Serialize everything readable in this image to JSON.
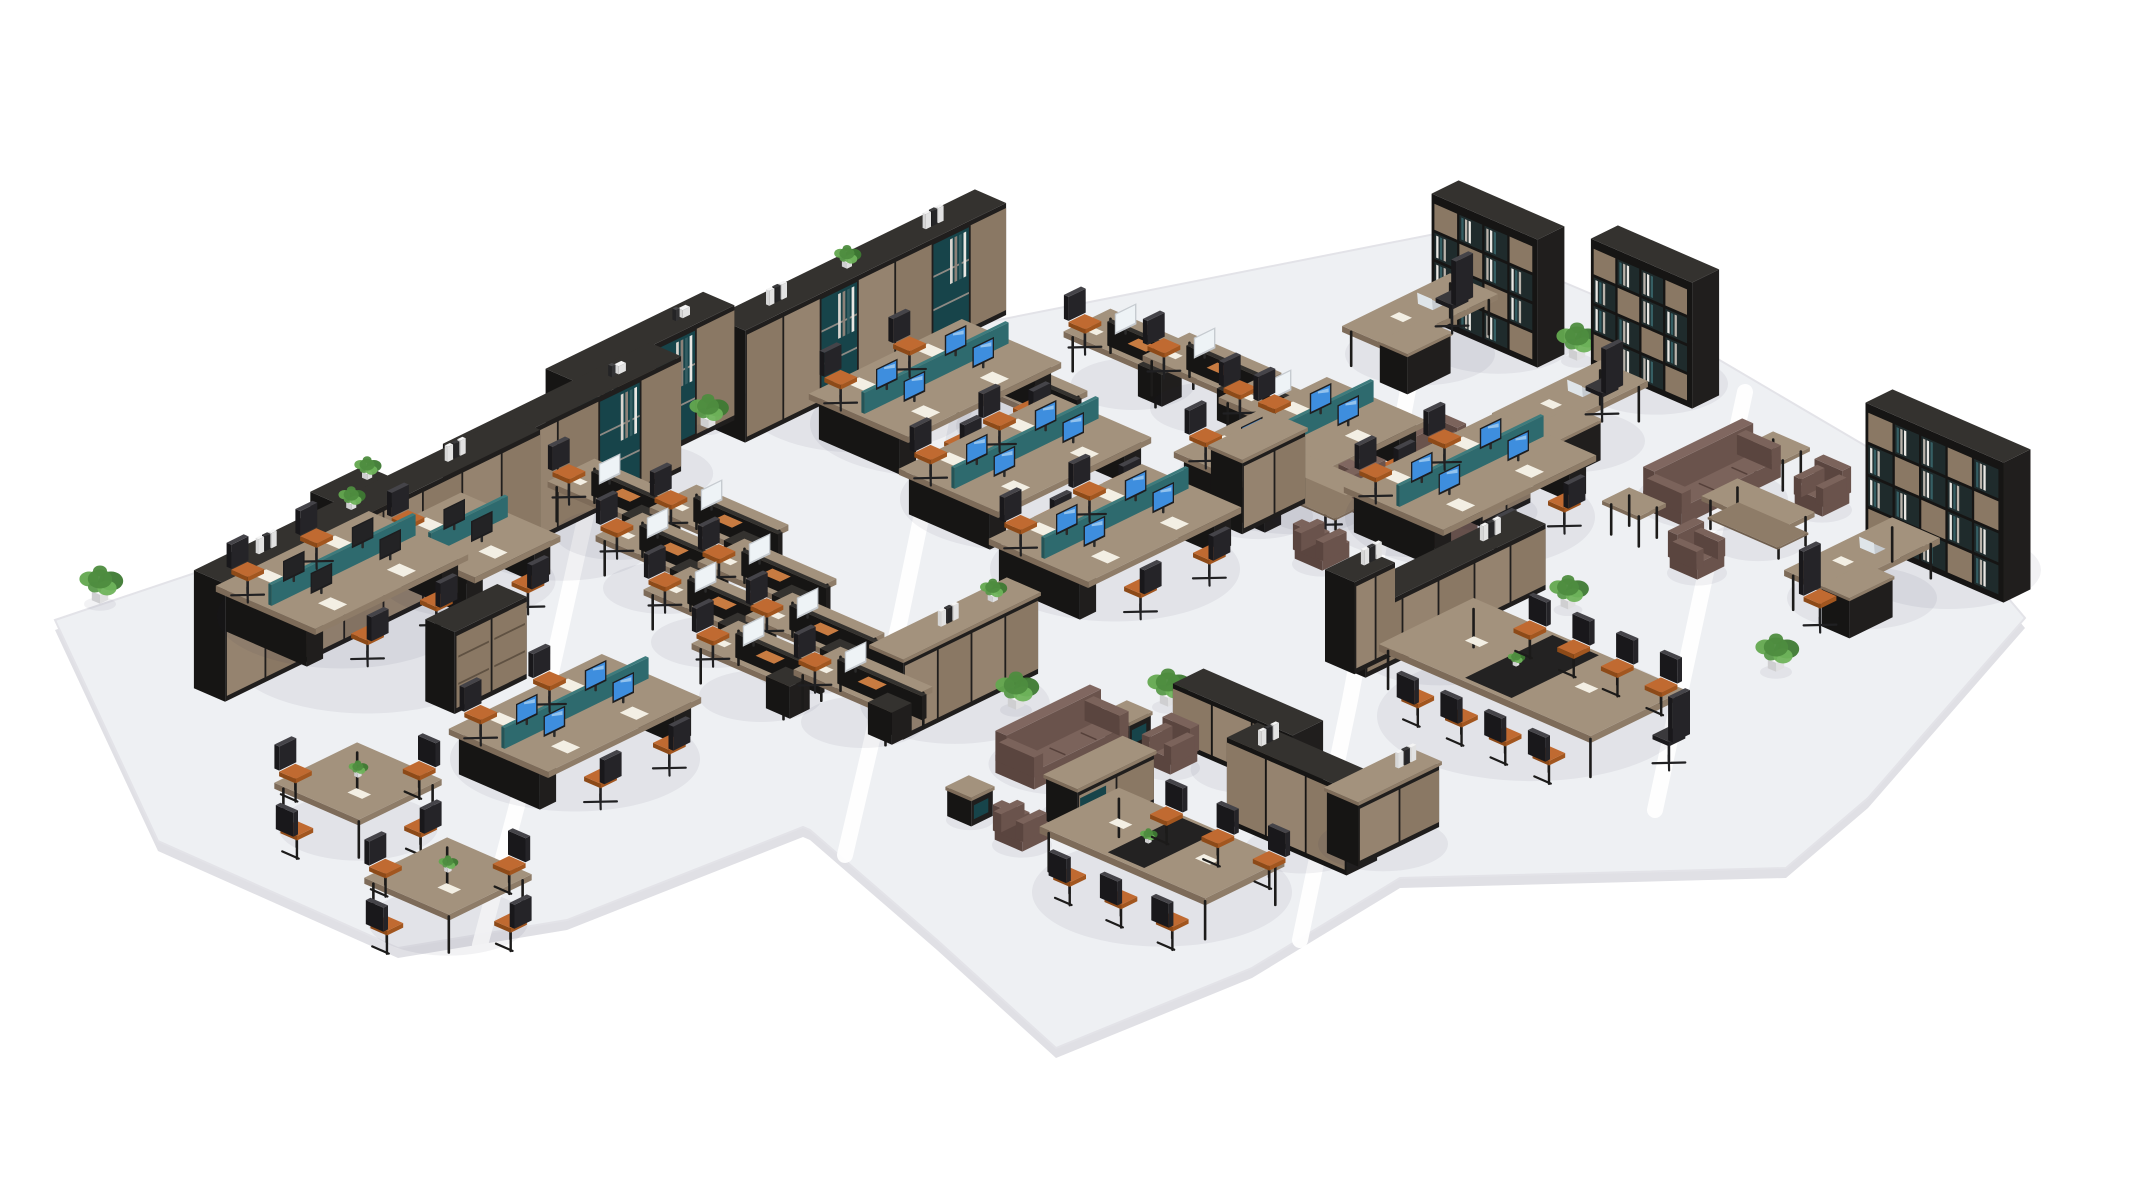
{
  "scene": {
    "width": 2137,
    "height": 1200,
    "background": "#ffffff",
    "floor": {
      "outline": [
        [
          55,
          620
        ],
        [
          585,
          442
        ],
        [
          607,
          452
        ],
        [
          938,
          314
        ],
        [
          968,
          326
        ],
        [
          1445,
          232
        ],
        [
          1648,
          318
        ],
        [
          1893,
          462
        ],
        [
          2025,
          618
        ],
        [
          1868,
          798
        ],
        [
          1786,
          868
        ],
        [
          1400,
          878
        ],
        [
          1252,
          968
        ],
        [
          1056,
          1048
        ],
        [
          937,
          940
        ],
        [
          810,
          830
        ],
        [
          803,
          827
        ],
        [
          567,
          920
        ],
        [
          398,
          948
        ],
        [
          158,
          841
        ]
      ],
      "seams": [
        [
          [
            600,
            452
          ],
          [
            545,
            700
          ],
          [
            480,
            945
          ]
        ],
        [
          [
            962,
            320
          ],
          [
            900,
            620
          ],
          [
            845,
            855
          ]
        ],
        [
          [
            1420,
            326
          ],
          [
            1350,
            700
          ],
          [
            1300,
            940
          ]
        ],
        [
          [
            1745,
            392
          ],
          [
            1700,
            600
          ],
          [
            1655,
            810
          ]
        ]
      ]
    },
    "items": [
      {
        "t": "bookcase",
        "n": "exec-bookcase-1",
        "x": 1498,
        "y": 338,
        "len": 115,
        "h": 128
      },
      {
        "t": "execDesk",
        "n": "exec-desk-1",
        "x": 1420,
        "y": 350,
        "cx2": 1452,
        "cy2": 328,
        "cdir": "-x"
      },
      {
        "t": "plant",
        "n": "plant",
        "x": 1577,
        "y": 357,
        "s": 1
      },
      {
        "t": "bookcase",
        "n": "exec-bookcase-2",
        "x": 1655,
        "y": 380,
        "len": 110,
        "h": 126
      },
      {
        "t": "shelfRow",
        "n": "bookshelf-row-back-mid",
        "x": 860,
        "y": 372,
        "len": 290,
        "h": 112,
        "style": "mixed",
        "top": [
          "binders",
          "plant",
          "binders"
        ]
      },
      {
        "t": "execDesk",
        "n": "exec-desk-2",
        "x": 1570,
        "y": 437,
        "cx2": 1602,
        "cy2": 416,
        "cdir": "-x"
      },
      {
        "t": "singleDesk",
        "n": "single-desk",
        "x": 1133,
        "y": 380
      },
      {
        "t": "singleDesk",
        "n": "single-desk",
        "x": 1212,
        "y": 404
      },
      {
        "t": "singleDesk",
        "n": "single-desk",
        "x": 1018,
        "y": 422
      },
      {
        "t": "singleDesk",
        "n": "single-desk",
        "x": 1288,
        "y": 446
      },
      {
        "t": "bench",
        "n": "workstation-bench",
        "x": 935,
        "y": 420,
        "seats": 4,
        "scr": "blue"
      },
      {
        "t": "shelfRow",
        "n": "bookshelf-row-c",
        "x": 640,
        "y": 452,
        "len": 175,
        "h": 115,
        "style": "books",
        "top": [
          "deco"
        ]
      },
      {
        "t": "plant",
        "n": "plant",
        "x": 708,
        "y": 425,
        "s": 0.9
      },
      {
        "t": "cube",
        "n": "side-cube",
        "x": 1295,
        "y": 455
      },
      {
        "t": "armchair",
        "n": "lounge-armchair",
        "x": 1437,
        "y": 463,
        "dir": "+y"
      },
      {
        "t": "bench",
        "n": "workstation-bench",
        "x": 1300,
        "y": 478,
        "seats": 4,
        "scr": "blue"
      },
      {
        "t": "sofa",
        "n": "lounge-sofa",
        "x": 1408,
        "y": 521,
        "axis": "x",
        "len": 110
      },
      {
        "t": "sideTable",
        "n": "side-table",
        "x": 1778,
        "y": 480
      },
      {
        "t": "bench",
        "n": "workstation-bench",
        "x": 1025,
        "y": 495,
        "seats": 4,
        "scr": "blue"
      },
      {
        "t": "plant",
        "n": "plant",
        "x": 590,
        "y": 498,
        "s": 1
      },
      {
        "t": "sofa",
        "n": "lounge-sofa",
        "x": 1712,
        "y": 495,
        "axis": "y",
        "len": 110
      },
      {
        "t": "coffeeTable",
        "n": "coffee-table",
        "x": 1315,
        "y": 508
      },
      {
        "t": "credenza",
        "n": "low-credenza",
        "x": 1490,
        "y": 508,
        "len": 55,
        "h": 46
      },
      {
        "t": "armchair",
        "n": "lounge-armchair",
        "x": 1822,
        "y": 506,
        "dir": "+y"
      },
      {
        "t": "credenza",
        "n": "low-credenza",
        "x": 1258,
        "y": 512,
        "len": 70,
        "h": 72
      },
      {
        "t": "bench",
        "n": "workstation-bench",
        "x": 1470,
        "y": 513,
        "seats": 4,
        "scr": "blue"
      },
      {
        "t": "shelfRow",
        "n": "bookshelf-row-b",
        "x": 562,
        "y": 515,
        "len": 230,
        "h": 115,
        "style": "mixed",
        "top": [
          "deco"
        ]
      },
      {
        "t": "singleDesk",
        "n": "single-desk",
        "x": 617,
        "y": 530
      },
      {
        "t": "sideTable",
        "n": "side-table",
        "x": 1634,
        "y": 536
      },
      {
        "t": "coffeeTable",
        "n": "coffee-table",
        "x": 1758,
        "y": 537
      },
      {
        "t": "singleDesk",
        "n": "single-desk",
        "x": 719,
        "y": 556
      },
      {
        "t": "bench",
        "n": "workstation-bench",
        "x": 1115,
        "y": 565,
        "seats": 4,
        "scr": "blue"
      },
      {
        "t": "armchair",
        "n": "lounge-armchair",
        "x": 1322,
        "y": 560,
        "dir": "-y"
      },
      {
        "t": "bookcase",
        "n": "exec-bookcase-3",
        "x": 1948,
        "y": 566,
        "len": 150,
        "h": 140
      },
      {
        "t": "armchair",
        "n": "lounge-armchair",
        "x": 1697,
        "y": 569,
        "dir": "+x"
      },
      {
        "t": "cabinet",
        "n": "storage-cabinet",
        "x": 352,
        "y": 585,
        "len": 60,
        "h": 100,
        "top": [
          "plant"
        ]
      },
      {
        "t": "singleDesk",
        "n": "single-desk",
        "x": 665,
        "y": 584
      },
      {
        "t": "plant",
        "n": "plant",
        "x": 1568,
        "y": 606,
        "s": 0.9
      },
      {
        "t": "execDesk",
        "n": "exec-desk-3",
        "x": 1862,
        "y": 594,
        "cx2": 1820,
        "cy2": 627,
        "cdir": "+x",
        "orange": true
      },
      {
        "t": "plant",
        "n": "plant",
        "x": 100,
        "y": 600,
        "s": 1
      },
      {
        "t": "singleDesk",
        "n": "single-desk",
        "x": 767,
        "y": 610
      },
      {
        "t": "shelfRow",
        "n": "cabinet-row-left",
        "x": 367,
        "y": 618,
        "len": 350,
        "h": 118,
        "style": "doors",
        "top": [
          "binders",
          "plant",
          "binders"
        ]
      },
      {
        "t": "bench",
        "n": "workstation-bench",
        "x": 468,
        "y": 577,
        "seats": 2,
        "scr": "dark"
      },
      {
        "t": "bench",
        "n": "workstation-bench",
        "x": 342,
        "y": 612,
        "seats": 4,
        "scr": "dark"
      },
      {
        "t": "shelfRow",
        "n": "credenza-row-right",
        "x": 1440,
        "y": 627,
        "len": 200,
        "h": 66,
        "style": "doors",
        "top": [
          "binders"
        ]
      },
      {
        "t": "cabinet",
        "n": "storage-cabinet",
        "x": 1360,
        "y": 658,
        "len": 45,
        "h": 92,
        "top": [
          "binders"
        ]
      },
      {
        "t": "singleDesk",
        "n": "single-desk",
        "x": 713,
        "y": 638
      },
      {
        "t": "plant",
        "n": "plant",
        "x": 810,
        "y": 655,
        "s": 1
      },
      {
        "t": "singleDesk",
        "n": "single-desk",
        "x": 815,
        "y": 664
      },
      {
        "t": "plant",
        "n": "plant",
        "x": 1776,
        "y": 668,
        "s": 1
      },
      {
        "t": "cabinet",
        "n": "drawer-cabinet",
        "x": 476,
        "y": 690,
        "len": 80,
        "h": 82,
        "style": "drawers"
      },
      {
        "t": "singleDesk",
        "n": "single-desk",
        "x": 761,
        "y": 692
      },
      {
        "t": "credenza",
        "n": "credenza-mid",
        "x": 955,
        "y": 700,
        "len": 150,
        "h": 78,
        "top": [
          "plant",
          "binders"
        ]
      },
      {
        "t": "plant",
        "n": "plant",
        "x": 1016,
        "y": 706,
        "s": 1
      },
      {
        "t": "plant",
        "n": "plant",
        "x": 1168,
        "y": 703,
        "s": 1
      },
      {
        "t": "singleDesk",
        "n": "single-desk",
        "x": 863,
        "y": 718
      },
      {
        "t": "confTable",
        "n": "conference-table-large",
        "x": 1532,
        "y": 712,
        "len": 230,
        "dep": 105,
        "chairs": 4,
        "head": true
      },
      {
        "t": "cube",
        "n": "side-cube",
        "x": 1128,
        "y": 741
      },
      {
        "t": "bench",
        "n": "workstation-bench",
        "x": 575,
        "y": 755,
        "seats": 4,
        "scr": "blue"
      },
      {
        "t": "sofa",
        "n": "lounge-sofa",
        "x": 1062,
        "y": 760,
        "axis": "y",
        "len": 105
      },
      {
        "t": "shelfRow",
        "n": "credenza-row-mid-1",
        "x": 1248,
        "y": 762,
        "len": 130,
        "h": 60,
        "style": "doors",
        "axis": "x"
      },
      {
        "t": "armchair",
        "n": "lounge-armchair",
        "x": 1170,
        "y": 764,
        "dir": "+y"
      },
      {
        "t": "credenza",
        "n": "tv-credenza",
        "x": 1100,
        "y": 816,
        "len": 85,
        "h": 50,
        "open": true
      },
      {
        "t": "cube",
        "n": "side-cube",
        "x": 970,
        "y": 816
      },
      {
        "t": "meetTable",
        "n": "meeting-table",
        "x": 358,
        "y": 823
      },
      {
        "t": "armchair",
        "n": "lounge-armchair",
        "x": 1022,
        "y": 841,
        "dir": "-y"
      },
      {
        "t": "shelfRow",
        "n": "credenza-row-mid-2",
        "x": 1302,
        "y": 842,
        "len": 130,
        "h": 86,
        "style": "doors",
        "axis": "x",
        "top": [
          "binders"
        ]
      },
      {
        "t": "credenza",
        "n": "low-credenza",
        "x": 1383,
        "y": 840,
        "len": 90,
        "h": 62,
        "top": [
          "binders"
        ]
      },
      {
        "t": "confTable",
        "n": "conference-table-small",
        "x": 1162,
        "y": 888,
        "len": 180,
        "dep": 88,
        "chairs": 3,
        "head": false
      },
      {
        "t": "meetTable",
        "n": "meeting-table",
        "x": 448,
        "y": 918
      }
    ]
  },
  "palette": {
    "floor": "#eef0f3",
    "floor_edge": "#e0e0e5",
    "floor_line": "#e3e3e8",
    "seam": "#ffffff",
    "wood_top": "#a3927d",
    "wood_right": "#8e7c68",
    "wood_front": "#7d6b59",
    "dark_top": "#34322f",
    "dark_right": "#201e1d",
    "dark_front": "#161514",
    "teal_top": "#3d7b7d",
    "teal_right": "#2e6a6e",
    "teal_front": "#245457",
    "teal_cubby": "#17444a",
    "screen_blue": "#3e8ede",
    "screen_blue_hi": "#a8d0f0",
    "screen_dark": "#232325",
    "monitor_silver": "#c6cbd0",
    "monitor_screen": "#eef3f6",
    "orange_seat": "#c06a31",
    "chair_black": "#242326",
    "sofa_top": "#7b635b",
    "sofa_right": "#6a534c",
    "sofa_front": "#5a453f",
    "plant_greens": [
      "#4e8c3f",
      "#63a84f",
      "#3e7a33",
      "#58994a",
      "#6fb35b"
    ],
    "pot": "#f0f0f0",
    "paper": "#f3efe4",
    "orange_pad": "#c77b41"
  }
}
